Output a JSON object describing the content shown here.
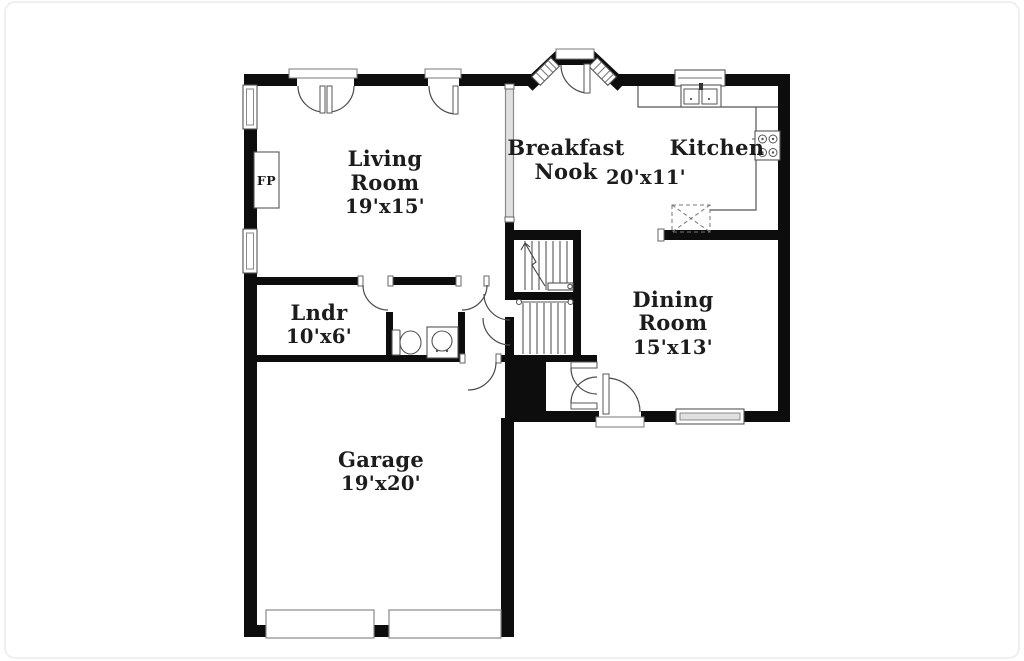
{
  "plan": {
    "type": "residential-first-floor-plan",
    "colors": {
      "background": "#ffffff",
      "walls": "#0d0d0d",
      "thin_lines": "#555555",
      "window_fill": "#e0e0e0",
      "text": "#1c1c1c"
    },
    "rooms": {
      "living_room": {
        "name_line1": "Living",
        "name_line2": "Room",
        "dimensions": "19'x15'"
      },
      "breakfast_nook": {
        "name_line1": "Breakfast",
        "name_line2": "Nook",
        "dimensions": "20'x11'"
      },
      "kitchen": {
        "name_line1": "Kitchen"
      },
      "dining_room": {
        "name_line1": "Dining",
        "name_line2": "Room",
        "dimensions": "15'x13'"
      },
      "laundry": {
        "name_line1": "Lndr",
        "dimensions": "10'x6'"
      },
      "garage": {
        "name_line1": "Garage",
        "dimensions": "19'x20'"
      },
      "fireplace": {
        "label": "FP"
      }
    }
  }
}
